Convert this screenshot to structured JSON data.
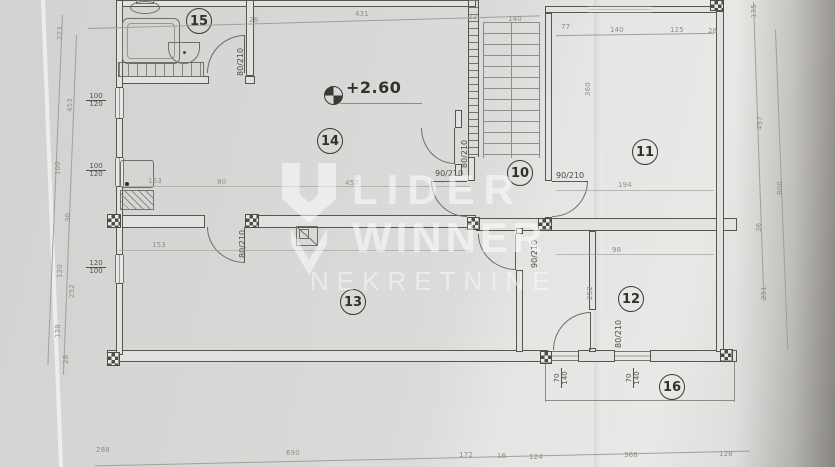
{
  "photo": {
    "paper_color": "#dcdbd9",
    "background_color": "#a9a8a6",
    "accent_line_color": "#57554f"
  },
  "watermark": {
    "logo": "lider-winner-logo",
    "line1": "LIDER",
    "line2": "WINNER",
    "line3": "NEKRETNINE",
    "color": "#ffffff"
  },
  "plan": {
    "elevation_label": "+2.60",
    "rooms": [
      {
        "number": "15"
      },
      {
        "number": "14"
      },
      {
        "number": "11"
      },
      {
        "number": "10"
      },
      {
        "number": "13"
      },
      {
        "number": "12"
      },
      {
        "number": "16"
      }
    ],
    "door_labels": {
      "bathroom": "80/210",
      "room14": "80/210",
      "hall_left": "90/210",
      "hall_right": "90/210",
      "hall_bottom": "90/210",
      "room13": "80/210",
      "room12": "80/210"
    },
    "window_labels": {
      "left_top": {
        "w": "100",
        "h": "120"
      },
      "left_mid": {
        "w": "100",
        "h": "120"
      },
      "left_bottom": {
        "w": "120",
        "h": "100"
      },
      "bottom_left": {
        "w": "70",
        "h": "140"
      },
      "bottom_right": {
        "w": "70",
        "h": "140"
      }
    },
    "dimensions": {
      "top": [
        "26",
        "431",
        "22",
        "140"
      ],
      "room11_top": [
        "77",
        "140",
        "125",
        "28"
      ],
      "right": [
        "135",
        "457",
        "36",
        "251"
      ],
      "right_outer": [
        "800"
      ],
      "left": [
        "223",
        "453",
        "100",
        "36",
        "120",
        "252",
        "138",
        "28"
      ],
      "bottom": [
        "288",
        "690",
        "172",
        "16",
        "124",
        "366",
        "128"
      ],
      "room14_bottom": [
        "153",
        "80",
        "457"
      ],
      "room12": [
        "194",
        "98",
        "252"
      ],
      "room11_left": [
        "360"
      ],
      "room13": [
        "153"
      ]
    }
  }
}
